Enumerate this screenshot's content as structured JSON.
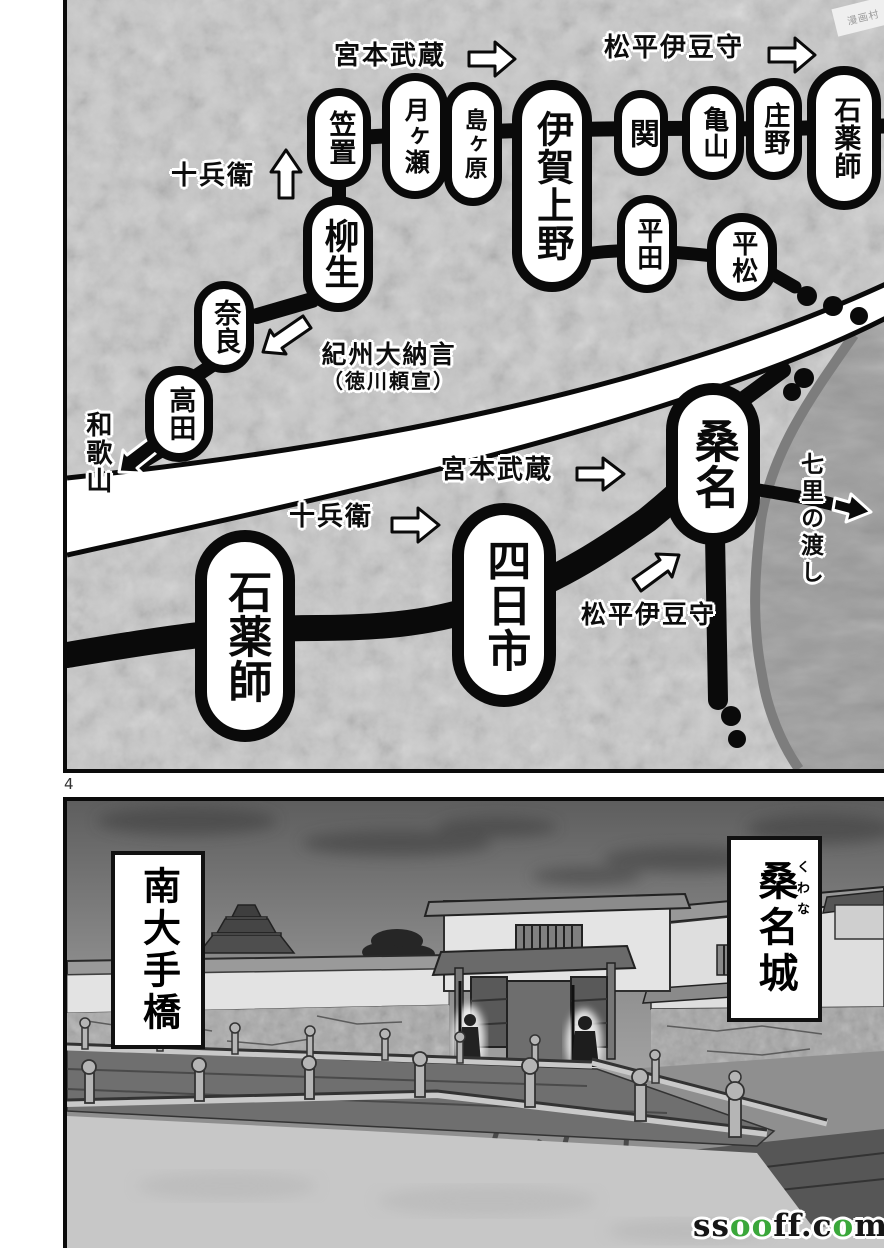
{
  "page": {
    "number": "4"
  },
  "map": {
    "stations": [
      {
        "id": "kasagi",
        "label": "笠置"
      },
      {
        "id": "tsukigase",
        "label": "月ヶ瀬"
      },
      {
        "id": "shimagahara",
        "label": "島ヶ原"
      },
      {
        "id": "iga-ueno",
        "label": "伊賀上野"
      },
      {
        "id": "seki",
        "label": "関"
      },
      {
        "id": "kameyama",
        "label": "亀山"
      },
      {
        "id": "shono",
        "label": "庄野"
      },
      {
        "id": "ishiyakushi",
        "label": "石薬師"
      },
      {
        "id": "hirata",
        "label": "平田"
      },
      {
        "id": "hiramatsu",
        "label": "平松"
      },
      {
        "id": "yagyu",
        "label": "柳生"
      },
      {
        "id": "nara",
        "label": "奈良"
      },
      {
        "id": "takada",
        "label": "高田"
      },
      {
        "id": "ishiyakushi-2",
        "label": "石薬師"
      },
      {
        "id": "yokkaichi",
        "label": "四日市"
      },
      {
        "id": "kuwana",
        "label": "桑名"
      }
    ],
    "labels": {
      "musashi": "宮本武蔵",
      "matsudaira": "松平伊豆守",
      "jubei": "十兵衛",
      "kishu_dainagon": "紀州大納言",
      "kishu_sub": "（徳川頼宣）",
      "wakayama": "和歌山",
      "shichiri": "七里の渡し"
    }
  },
  "scene": {
    "captions": {
      "bridge": "南大手橋",
      "castle": "桑名城",
      "castle_furigana": "くわな"
    }
  },
  "watermarks": {
    "corner_label": "漫画村",
    "site": {
      "seg1": "ss",
      "seg2": "oo",
      "seg3": "ff.c",
      "seg4": "o",
      "seg5": "m"
    }
  },
  "colors": {
    "ink": "#0a0a0a",
    "panel_bg": "#c9c9c9",
    "sea": "#9c9c9c",
    "site_green": "#3aa73a"
  }
}
